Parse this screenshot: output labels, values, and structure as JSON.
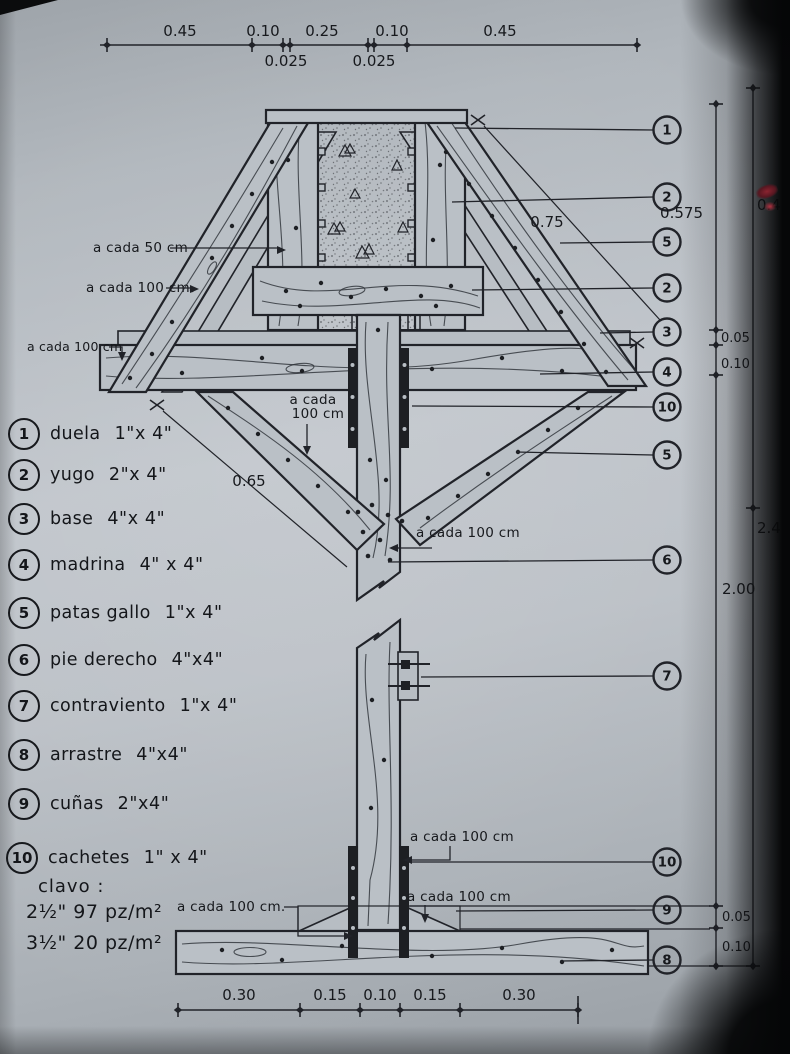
{
  "colors": {
    "ink": "#1d1f23",
    "paper": "#b9bfc5",
    "red_mark": "#8a2430"
  },
  "top_dims": {
    "d1": "0.45",
    "d2": "0.10",
    "d3": "0.25",
    "d4": "0.10",
    "d5": "0.45",
    "s1": "0.025",
    "s2": "0.025"
  },
  "bottom_dims": {
    "b1": "0.30",
    "b2": "0.15",
    "b3": "0.10",
    "b4": "0.15",
    "b5": "0.30"
  },
  "right_dims": {
    "r1": "0.575",
    "r2": "0.05",
    "r3": "0.10",
    "r4": "2.00",
    "r5": "0.05",
    "r6": "0.10",
    "o1": "0.40",
    "o2": "2.40"
  },
  "diag_dims": {
    "right": "0.75",
    "left": "0.65"
  },
  "annotations": {
    "a50": "a cada 50 cm",
    "a100_l1": "a cada 100 cm",
    "a100_l2": "a cada 100 cm",
    "ac1": "a cada",
    "ac2": "100 cm",
    "a100_mid": "a cada 100 cm",
    "a100_b1": "a cada 100 cm",
    "a100_b2": "a  cada 100 cm",
    "a100_clavo": "a cada 100 cm."
  },
  "legend": {
    "items": [
      {
        "num": "1",
        "name": "duela",
        "size": "1\"x 4\""
      },
      {
        "num": "2",
        "name": "yugo",
        "size": "2\"x 4\""
      },
      {
        "num": "3",
        "name": "base",
        "size": "4\"x 4\""
      },
      {
        "num": "4",
        "name": "madrina",
        "size": "4\" x 4\""
      },
      {
        "num": "5",
        "name": "patas gallo",
        "size": "1\"x 4\""
      },
      {
        "num": "6",
        "name": "pie derecho",
        "size": "4\"x4\""
      },
      {
        "num": "7",
        "name": "contraviento",
        "size": "1\"x 4\""
      },
      {
        "num": "8",
        "name": "arrastre",
        "size": "4\"x4\""
      },
      {
        "num": "9",
        "name": "cuñas",
        "size": "2\"x4\""
      },
      {
        "num": "10",
        "name": "cachetes",
        "size": "1\" x 4\""
      }
    ],
    "clavo_title": "clavo :",
    "clavo_1": "2½\" 97 pz/m²",
    "clavo_2": "3½\" 20 pz/m²"
  },
  "callouts": [
    "1",
    "2",
    "5",
    "2",
    "3",
    "4",
    "10",
    "5",
    "6",
    "7",
    "10",
    "9",
    "8"
  ]
}
